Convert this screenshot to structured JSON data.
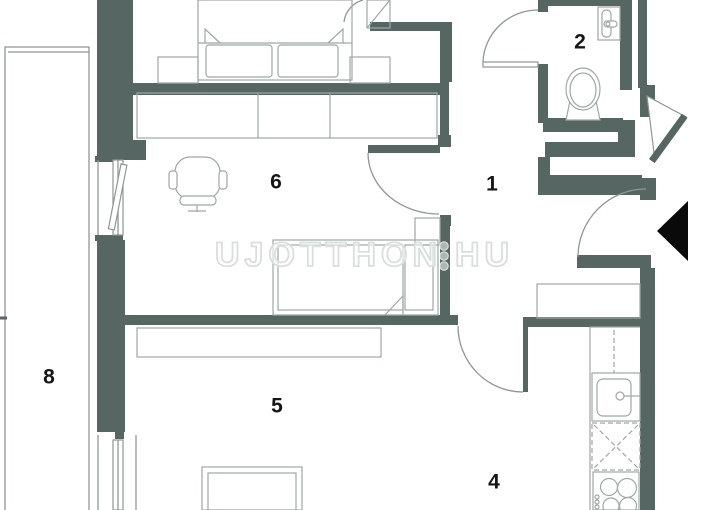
{
  "title": "Apartment floor plan",
  "watermark": {
    "left": "UJOTTHON",
    "right": "HU",
    "dot_count": 3
  },
  "rooms": [
    {
      "label": "1"
    },
    {
      "label": "2"
    },
    {
      "label": "4"
    },
    {
      "label": "5"
    },
    {
      "label": "6"
    },
    {
      "label": "8"
    }
  ],
  "colors": {
    "wall": "#566662",
    "line": "#8e9793",
    "furn": "#9ea8a4",
    "label": "#161616",
    "wm-stroke": "#d9dfdd",
    "wm-dot": "#aeb7b4",
    "arrow": "#0a0a0a"
  }
}
